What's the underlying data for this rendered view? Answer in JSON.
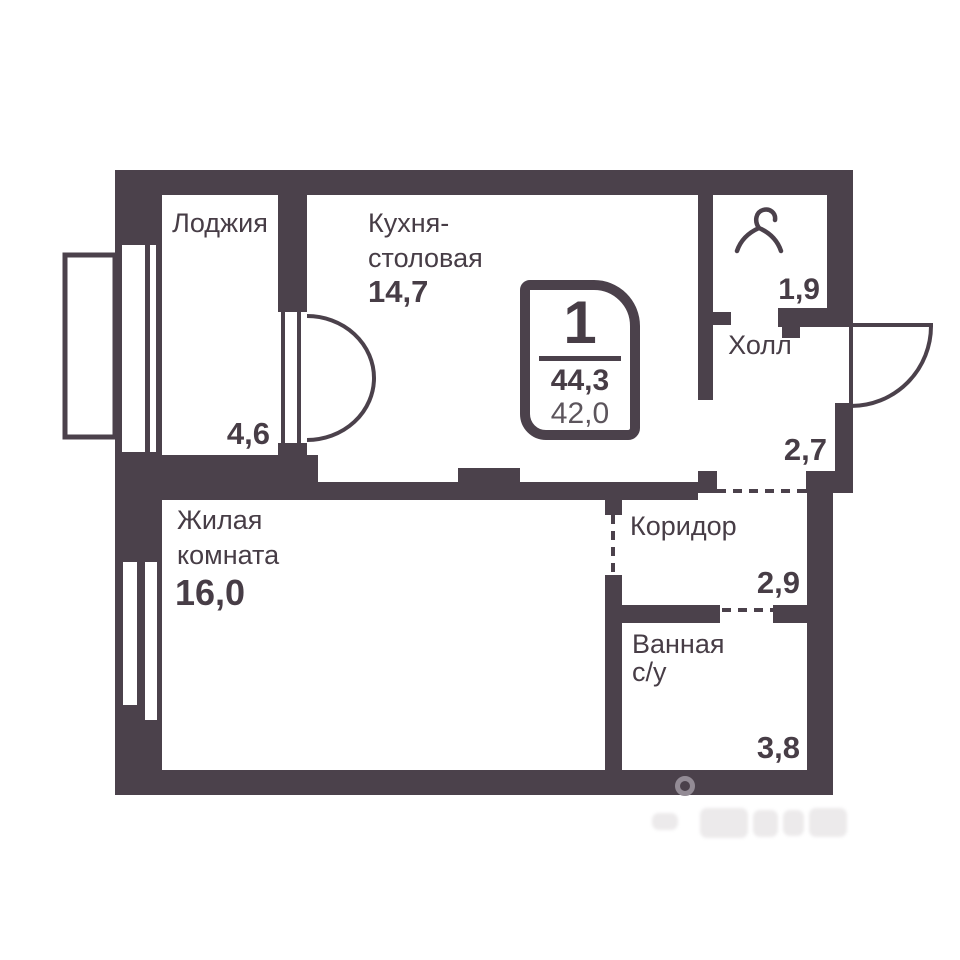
{
  "badge": {
    "rooms_count": "1",
    "total_area": "44,3",
    "living_area": "42,0"
  },
  "rooms": {
    "loggia": {
      "name": "Лоджия",
      "area": "4,6"
    },
    "kitchen": {
      "name_line1": "Кухня-",
      "name_line2": "столовая",
      "area": "14,7"
    },
    "wardrobe": {
      "area": "1,9"
    },
    "hall": {
      "name": "Холл",
      "area": "2,7"
    },
    "corridor": {
      "name": "Коридор",
      "area": "2,9"
    },
    "bathroom": {
      "name_line1": "Ванная",
      "name_line2": "с/у",
      "area": "3,8"
    },
    "living": {
      "name_line1": "Жилая",
      "name_line2": "комната",
      "area": "16,0"
    }
  },
  "icons": {
    "hanger": "hanger-icon",
    "entrance_door": "door-swing-icon",
    "balcony_doors": "double-door-swing-icon"
  },
  "colors": {
    "wall": "#4B414B",
    "text": "#473D46",
    "secondary_text": "#5C555C",
    "background": "#ffffff",
    "watermark": "#ECEAEB"
  }
}
